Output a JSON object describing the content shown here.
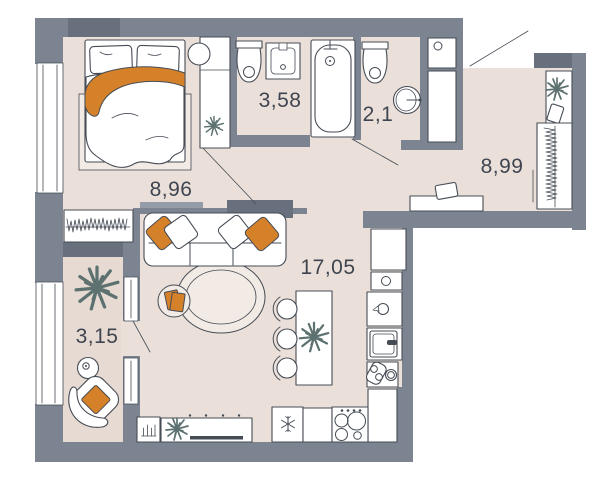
{
  "plan": {
    "type": "apartment-floor-plan",
    "rooms": [
      {
        "id": "bedroom",
        "area_label": "8,96"
      },
      {
        "id": "bathroom",
        "area_label": "3,58"
      },
      {
        "id": "wc",
        "area_label": "2,1"
      },
      {
        "id": "hallway",
        "area_label": "8,99"
      },
      {
        "id": "living-kitchen",
        "area_label": "17,05"
      },
      {
        "id": "balcony",
        "area_label": "3,15"
      }
    ],
    "colors": {
      "wall": "#7b8490",
      "wall-dark": "#67707c",
      "wall-mid": "#949ca7",
      "floor": "#eae0d9",
      "floor-balcony": "#e6dad2",
      "floor-light": "#f2eae4",
      "outline": "#464c55",
      "accent": "#d5812a",
      "plant": "#5c7170",
      "text": "#3f4550",
      "furniture": "#ffffff"
    },
    "icons": [
      "bed",
      "pillow",
      "blanket",
      "rug",
      "wardrobe",
      "mirror",
      "plant",
      "clothes-rack",
      "toilet",
      "sink",
      "bathtub",
      "ventilation-shaft",
      "shelf",
      "hanger-rod",
      "bench",
      "sofa",
      "pouf",
      "books",
      "kitchen-island",
      "bar-stool",
      "fridge-snowflake",
      "stove-burners",
      "kitchen-sink",
      "kettle",
      "cutting-board",
      "tv-stand",
      "tv",
      "radiator",
      "armchair",
      "side-table",
      "door-swing",
      "window"
    ]
  }
}
